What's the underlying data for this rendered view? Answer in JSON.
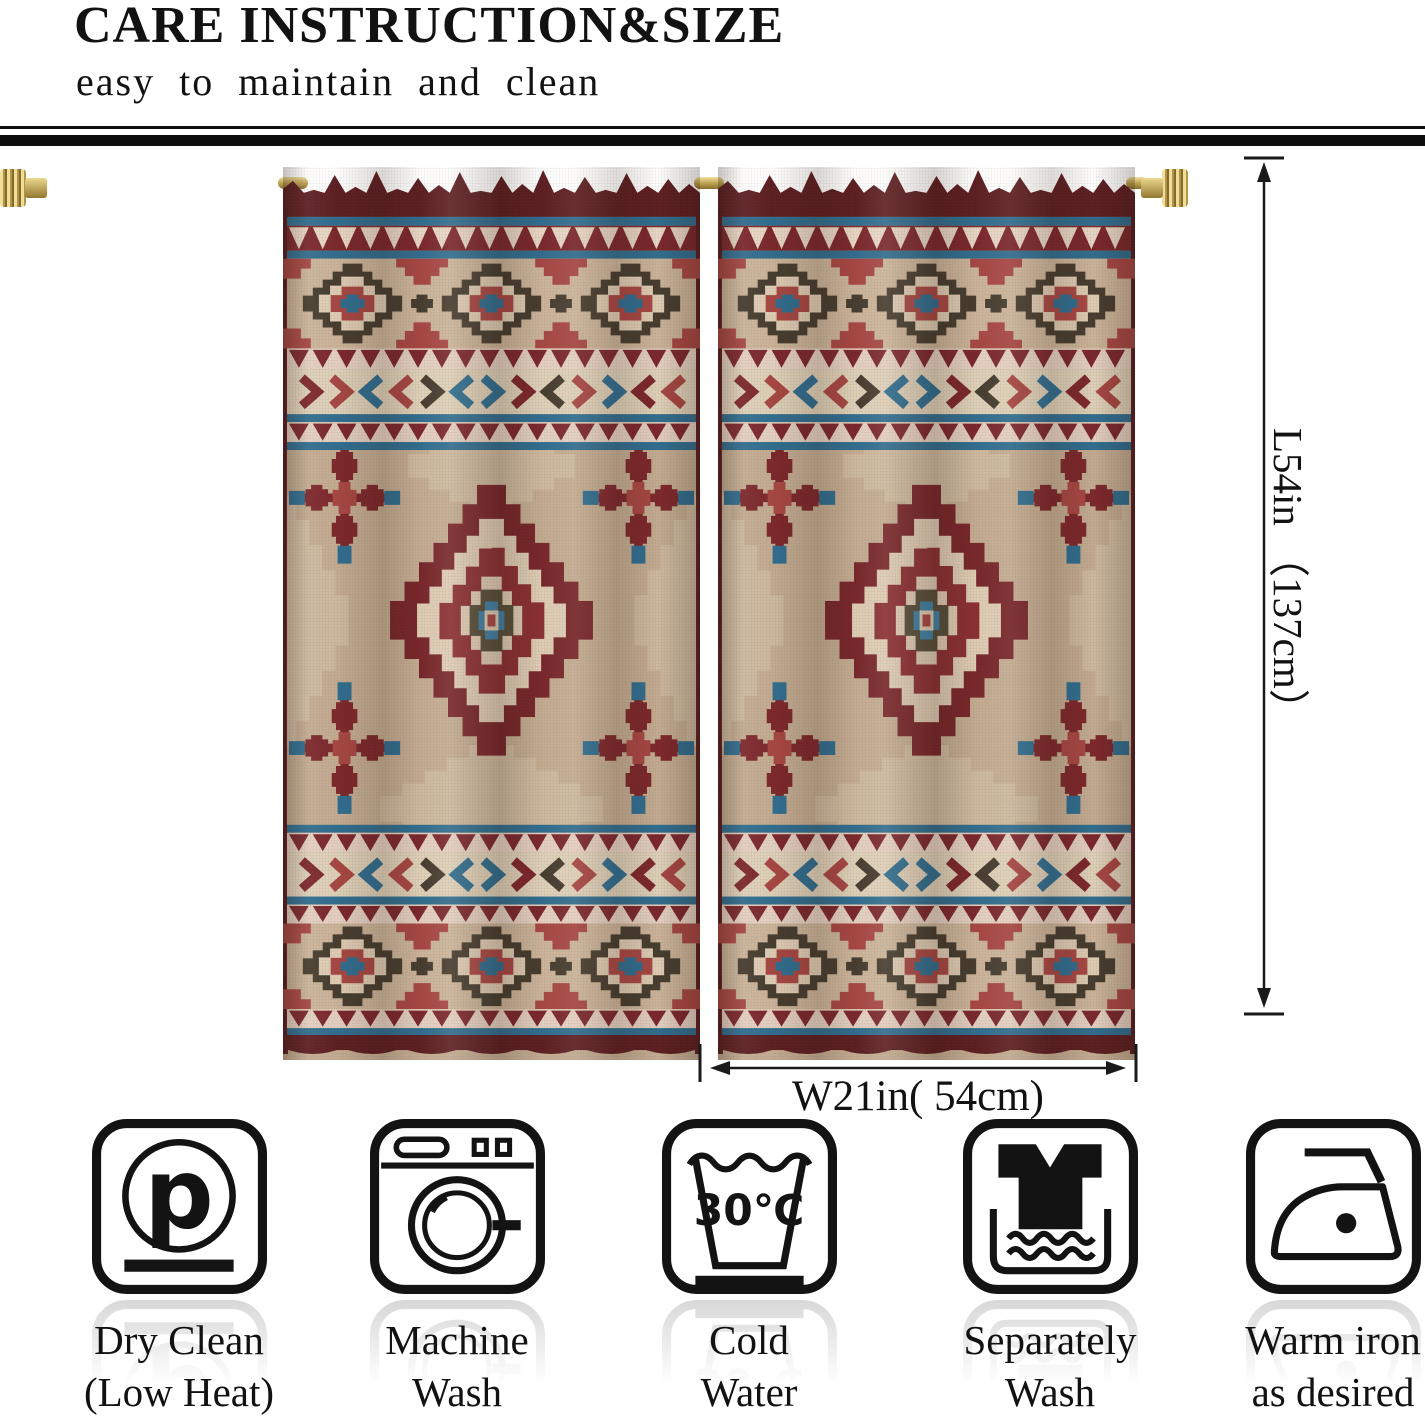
{
  "header": {
    "title": "CARE INSTRUCTION&SIZE",
    "subtitle": "easy to maintain and clean"
  },
  "product": {
    "name": "southwestern aztec curtain panels",
    "panel_count": 2
  },
  "dimensions": {
    "length_label": "L54in （137cm）",
    "width_label": "W21in( 54cm)"
  },
  "care_instructions": [
    {
      "icon": "dry-clean-icon",
      "label_line1": "Dry Clean",
      "label_line2": "(Low Heat)"
    },
    {
      "icon": "machine-wash-icon",
      "label_line1": "Machine",
      "label_line2": "Wash"
    },
    {
      "icon": "cold-water-icon",
      "label_line1": "Cold",
      "label_line2": "Water",
      "temperature": "30℃"
    },
    {
      "icon": "separately-wash-icon",
      "label_line1": "Separately",
      "label_line2": "Wash"
    },
    {
      "icon": "warm-iron-icon",
      "label_line1": "Warm iron",
      "label_line2": "as desired"
    }
  ],
  "colors": {
    "maroon": "#77262b",
    "maroon_bright": "#8a2f33",
    "dark_maroon": "#5c1e22",
    "red": "#a64643",
    "blue": "#2f6d90",
    "olive": "#453c2f",
    "tan": "#c2ab91",
    "tan_light": "#cab39a",
    "cream": "#ddcbb4",
    "pink": "#e3cfc0",
    "brass": "#c5a958",
    "ink": "#131313"
  }
}
